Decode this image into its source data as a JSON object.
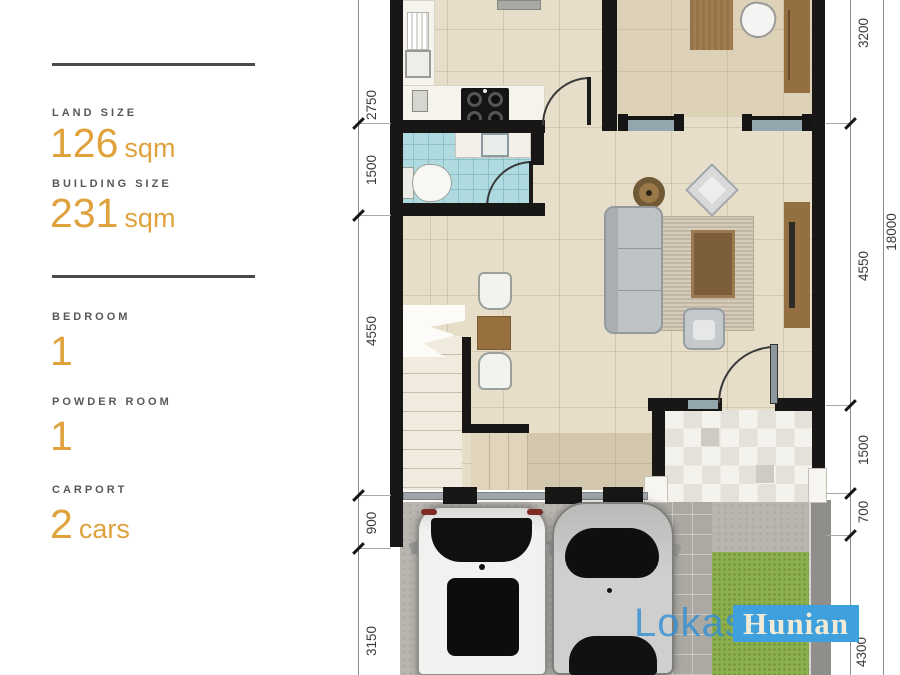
{
  "specs": {
    "top": [
      {
        "label": "LAND SIZE",
        "value": "126",
        "unit": "sqm"
      },
      {
        "label": "BUILDING SIZE",
        "value": "231",
        "unit": "sqm"
      }
    ],
    "bottom": [
      {
        "label": "BEDROOM",
        "value": "1",
        "unit": ""
      },
      {
        "label": "POWDER ROOM",
        "value": "1",
        "unit": ""
      },
      {
        "label": "CARPORT",
        "value": "2",
        "unit": "cars"
      }
    ]
  },
  "dimensions": {
    "left": [
      "2750",
      "1500",
      "4550",
      "900",
      "3150"
    ],
    "right": [
      "3200",
      "4550",
      "1500",
      "700",
      "4300"
    ],
    "total": "18000"
  },
  "watermark": {
    "primary": "Lokasi",
    "secondary": "Hunian"
  },
  "colors": {
    "accent_orange": "#dfa23c",
    "label_gray": "#58585c",
    "wall_black": "#181715",
    "floor_beige": "#e7deca",
    "bathroom_blue": "#afdae0",
    "lawn_green": "#8db04e",
    "concrete_gray": "#b9b6b0",
    "watermark_blue": "#3ea0dc",
    "wood_brown": "#936f42"
  }
}
